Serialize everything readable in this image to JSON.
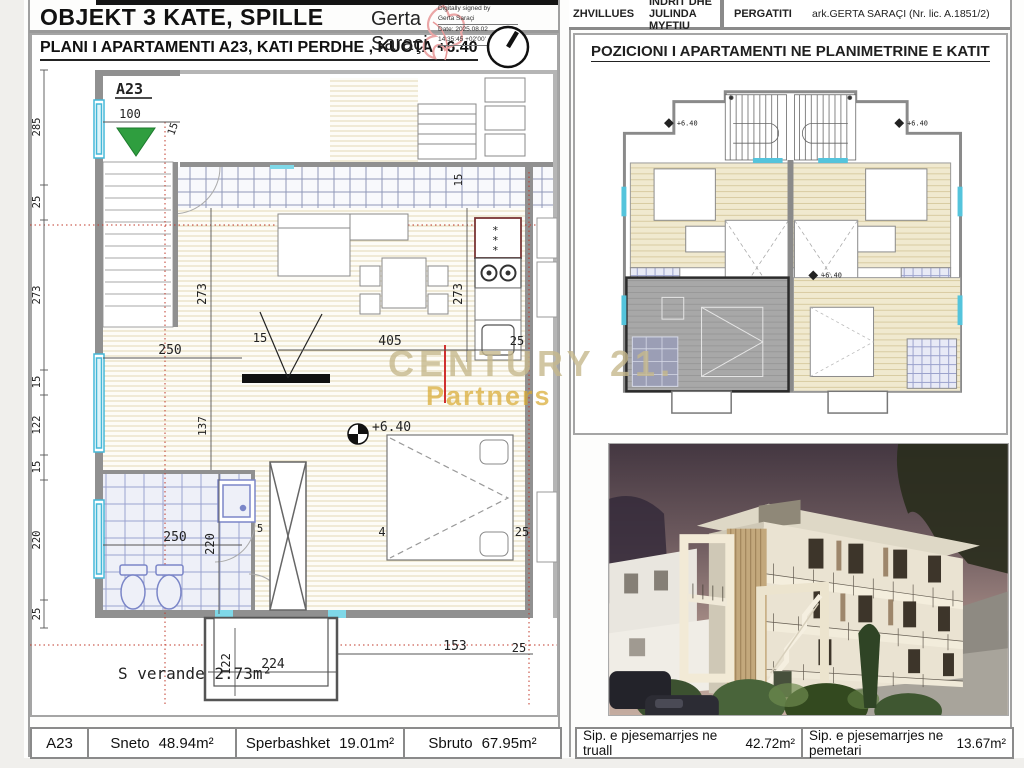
{
  "title_block": {
    "project_title": "OBJEKT 3 KATE, SPILLE",
    "drawing_title": "PLANI I APARTAMENTI A23, KATI PERDHE , KUOTA +6.40"
  },
  "signature": {
    "name_line1": "Gerta",
    "name_line2": "Saraçi",
    "lines": [
      "Digitally signed by",
      "Gerta Saraçi",
      "Date: 2025.08.02",
      "14:35:45 +02'00'"
    ]
  },
  "header_right": {
    "developer_label": "ZHVILLUES",
    "developer_value": "INDRIT DHE JULINDA MYFTIU",
    "prepared_label": "PERGATITI",
    "prepared_value": "ark.GERTA SARAÇI  (Nr. lic. A.1851/2)"
  },
  "key_plan": {
    "title": "POZICIONI I APARTAMENTI NE PLANIMETRINE E KATIT",
    "level_markers": [
      "+6.40",
      "+6.40",
      "+6.40"
    ]
  },
  "floor_plan": {
    "apartment_label": "A23",
    "level_marker": "+6.40",
    "veranda_label": "S verande  2.73m²",
    "dims": {
      "left": [
        "285",
        "25",
        "273",
        "15",
        "122",
        "15",
        "220",
        "25"
      ],
      "top": [
        "100",
        "15"
      ],
      "inner": [
        "273",
        "250",
        "15",
        "137",
        "405",
        "273",
        "25",
        "15",
        "4"
      ],
      "bath": [
        "250",
        "220",
        "5"
      ],
      "bottom": [
        "122",
        "224",
        "153",
        "25"
      ]
    }
  },
  "watermark": {
    "line1": "CENTURY 21.",
    "line2": "Partners"
  },
  "summary_bar": {
    "unit": "A23",
    "cells": [
      {
        "label": "Sneto",
        "value": "48.94m²"
      },
      {
        "label": "Sperbashket",
        "value": "19.01m²"
      },
      {
        "label": "Sbruto",
        "value": "67.95m²"
      },
      {
        "label": "Sip. e pjesemarrjes ne truall",
        "value": "42.72m²"
      },
      {
        "label": "Sip. e pjesemarrjes ne pemetari",
        "value": "13.67m²"
      }
    ]
  }
}
